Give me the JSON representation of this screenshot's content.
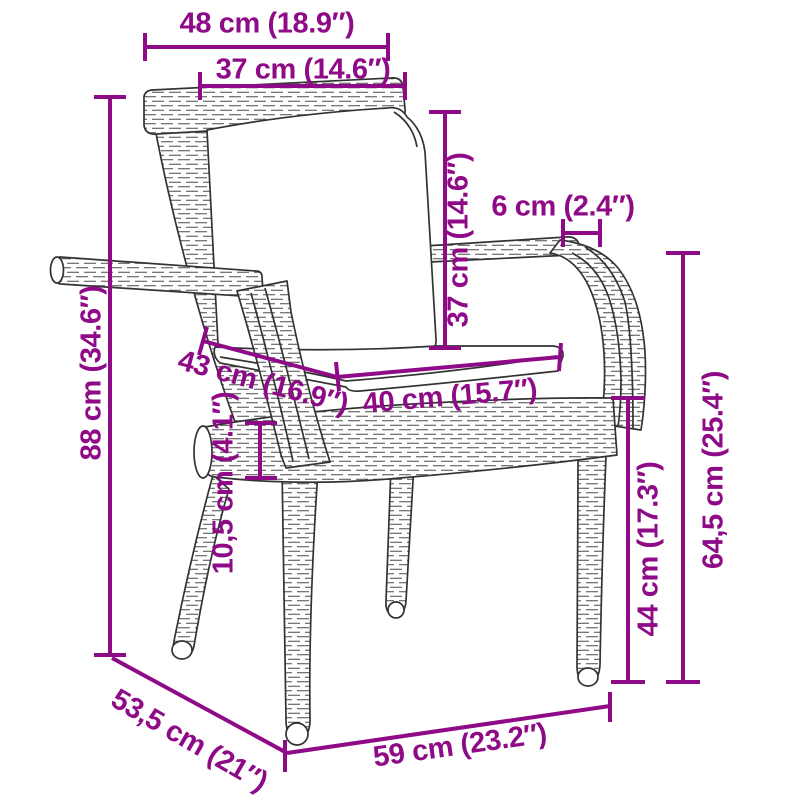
{
  "page": {
    "type": "product-dimension-diagram",
    "subject": "rattan garden chair with back and seat cushions",
    "background_color": "#ffffff"
  },
  "style": {
    "accent_color": "#8e0a87",
    "drawing_color": "#333333"
  },
  "labels": {
    "width_top": "48 cm (18.9″)",
    "backrest_cushion_width": "37 cm (14.6″)",
    "backrest_cushion_height": "37 cm (14.6″)",
    "armrest_width": "6 cm (2.4″)",
    "total_height": "88 cm (34.6″)",
    "seat_cushion_depth": "43 cm (16.9″)",
    "seat_cushion_width": "40 cm (15.7″)",
    "seat_frame_thickness": "10,5 cm (4.1″)",
    "seat_height": "44 cm (17.3″)",
    "armrest_height": "64,5 cm (25.4″)",
    "total_depth": "53,5 cm (21″)",
    "width_front": "59 cm (23.2″)"
  },
  "dimensions": [
    {
      "name": "overall width at top rail",
      "cm": 48,
      "inch": 18.9
    },
    {
      "name": "backrest cushion width",
      "cm": 37,
      "inch": 14.6
    },
    {
      "name": "backrest cushion height",
      "cm": 37,
      "inch": 14.6
    },
    {
      "name": "armrest width",
      "cm": 6,
      "inch": 2.4
    },
    {
      "name": "overall height",
      "cm": 88,
      "inch": 34.6
    },
    {
      "name": "seat cushion depth",
      "cm": 43,
      "inch": 16.9
    },
    {
      "name": "seat cushion width",
      "cm": 40,
      "inch": 15.7
    },
    {
      "name": "seat frame thickness",
      "cm": 10.5,
      "inch": 4.1
    },
    {
      "name": "seat height",
      "cm": 44,
      "inch": 17.3
    },
    {
      "name": "armrest height",
      "cm": 64.5,
      "inch": 25.4
    },
    {
      "name": "overall depth",
      "cm": 53.5,
      "inch": 21
    },
    {
      "name": "overall width at front",
      "cm": 59,
      "inch": 23.2
    }
  ]
}
